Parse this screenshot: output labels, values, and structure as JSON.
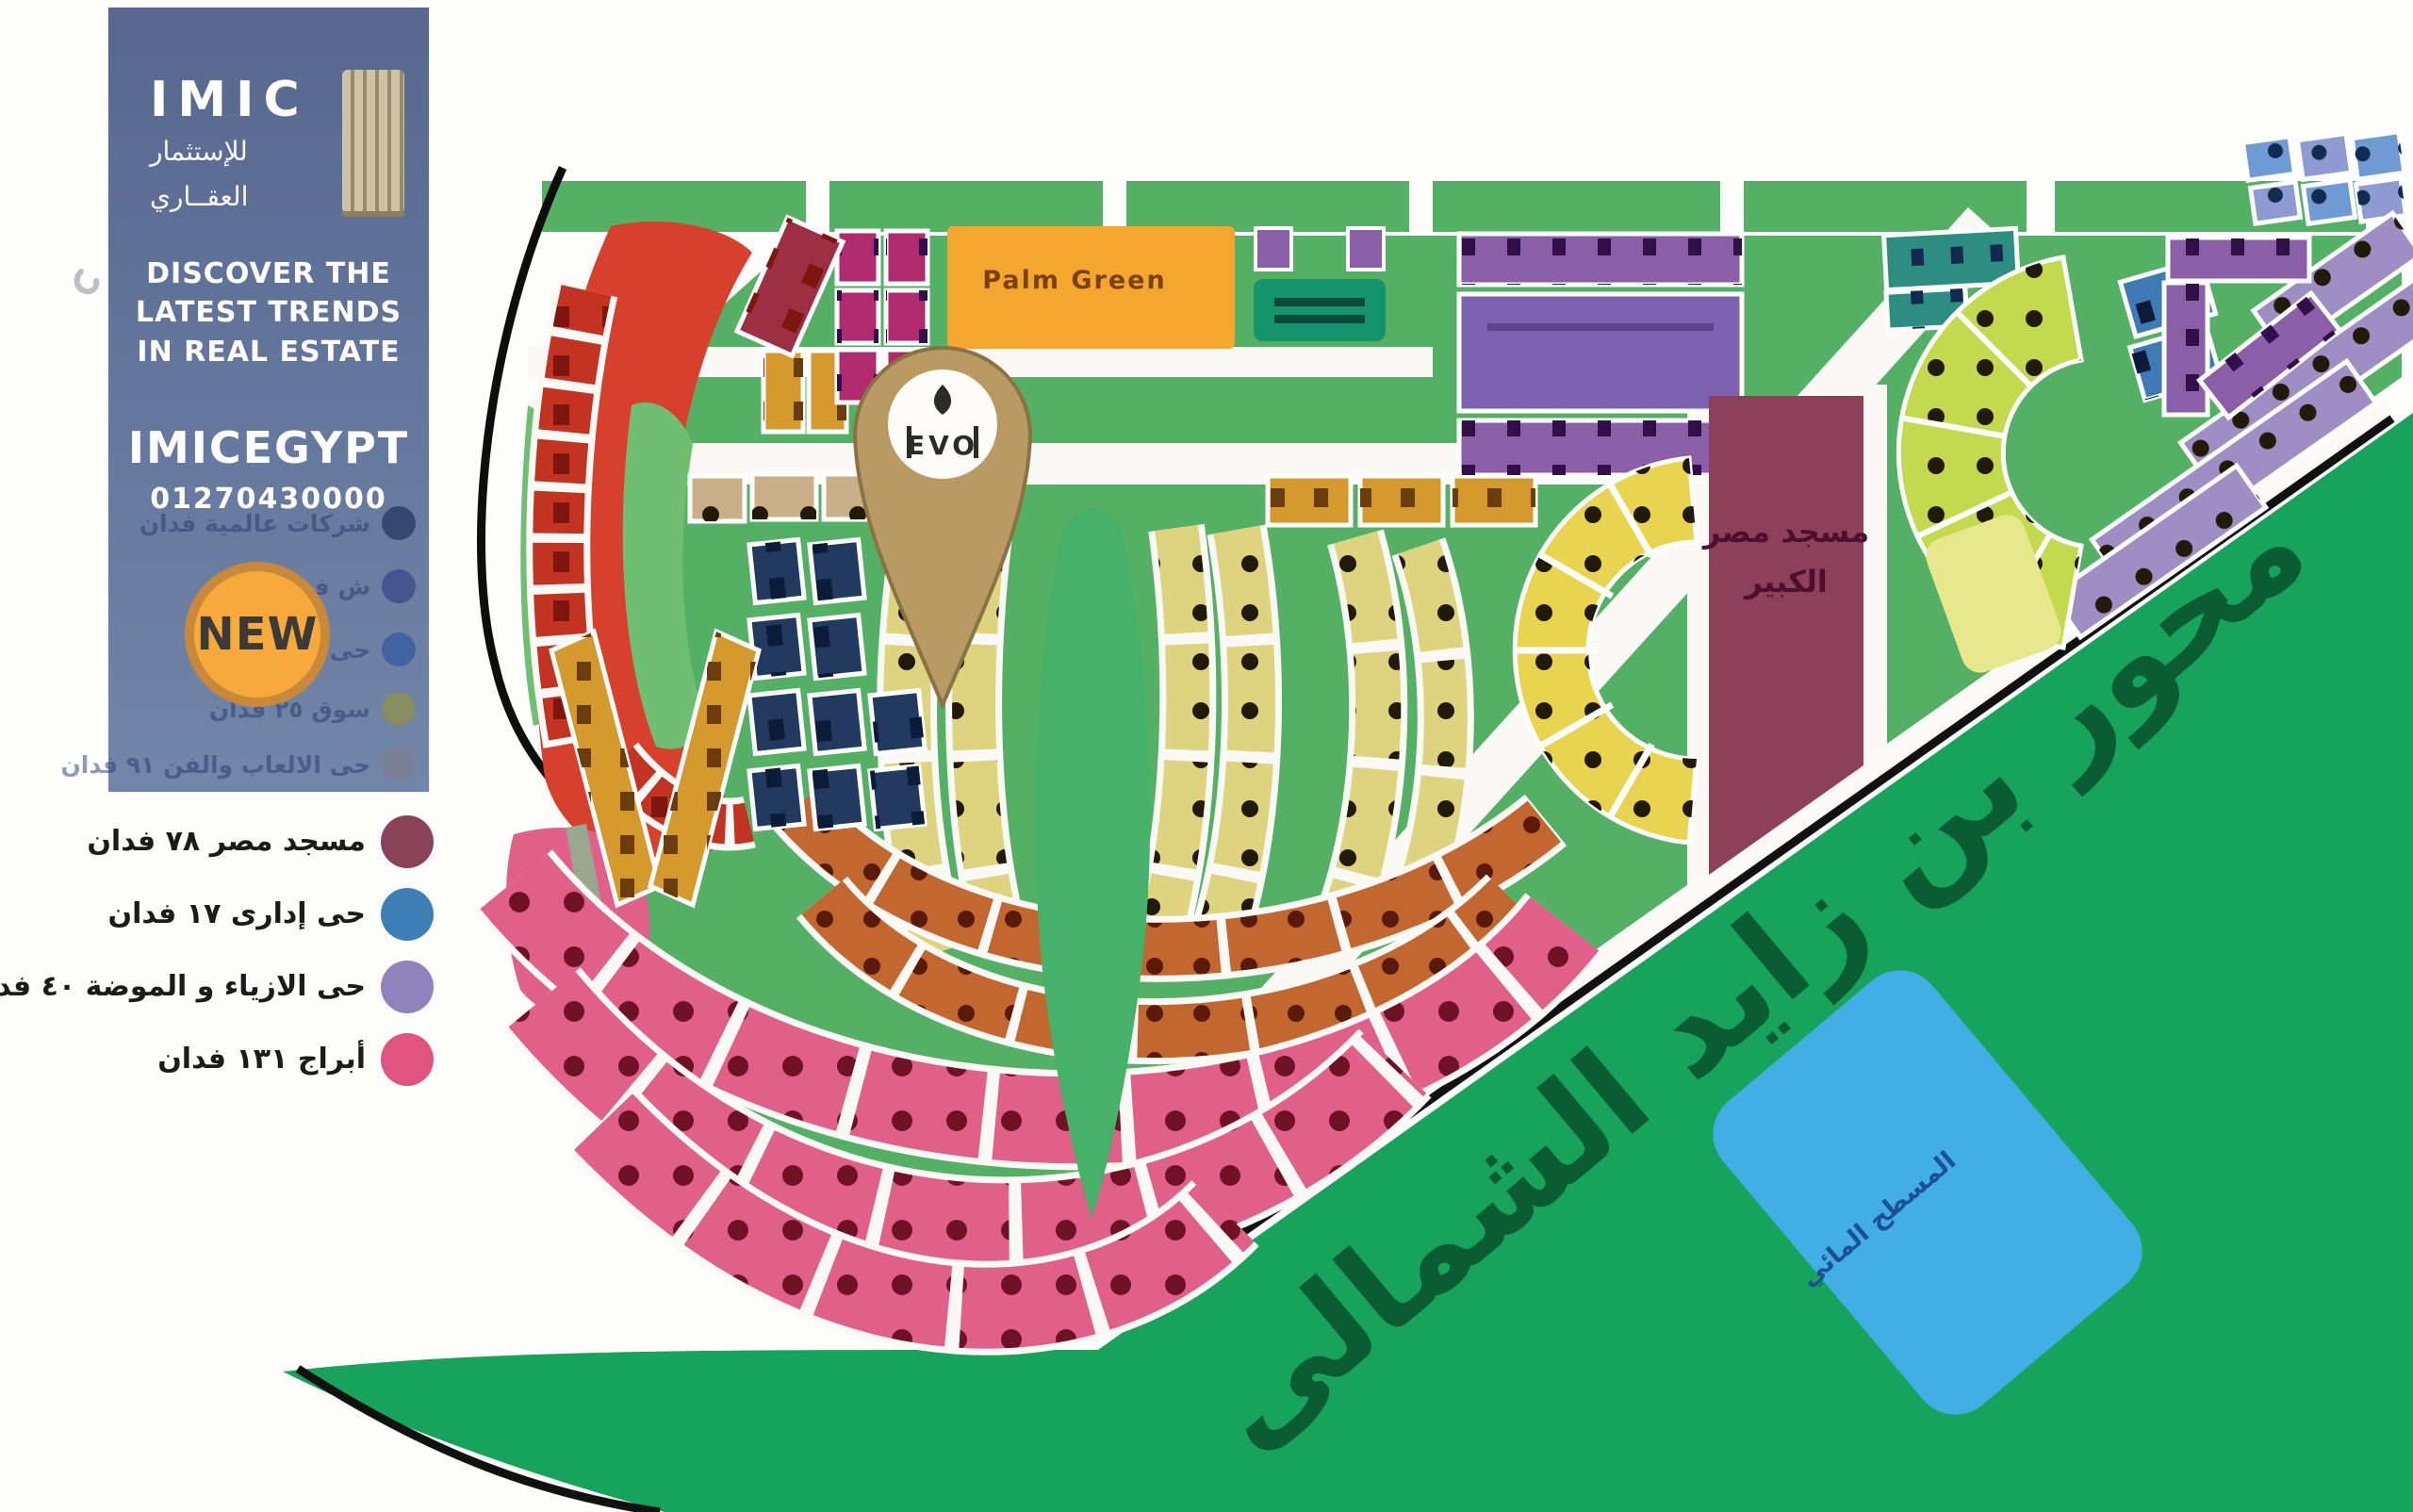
{
  "brand": {
    "logo_title": "IMIC",
    "logo_sub1": "للإستثمار",
    "logo_sub2": "العقــاري",
    "tagline1": "DISCOVER THE",
    "tagline2": "LATEST TRENDS",
    "tagline3": "IN REAL ESTATE",
    "handle": "IMICEGYPT",
    "phone": "01270430000",
    "badge": "NEW",
    "panel_color_top": "#57678e",
    "panel_color_bottom": "#7286a9",
    "badge_color": "#f7a93b",
    "badge_ring_color": "#c8893a",
    "faded_rows": [
      {
        "label": "شركات عالمية فدان",
        "color": "#2e3f66"
      },
      {
        "label": "ش فدان",
        "color": "#3d4f8a"
      },
      {
        "label": "حى فدان",
        "color": "#3a5fa0"
      },
      {
        "label": "سوق ٢٥ فدان",
        "color": "#8a8f55"
      },
      {
        "label": "حى الالعاب والفن ٩١ فدان",
        "color": "#7a7f93"
      }
    ]
  },
  "legend": {
    "items": [
      {
        "label": "مسجد مصر ٧٨ فدان",
        "color": "#8a4257"
      },
      {
        "label": "حى إدارى ١٧ فدان",
        "color": "#3f7fb5"
      },
      {
        "label": "حى الازياء و الموضة ٤٠ فدان",
        "color": "#8f83bd"
      },
      {
        "label": "أبراج ١٣١ فدان",
        "color": "#e0557f"
      }
    ]
  },
  "map": {
    "axis_road_label": "محور بن زايد الشمالى",
    "palm_green_label": "Palm Green",
    "mosque_label_1": "مسجد مصر",
    "mosque_label_2": "الكبير",
    "water_label": "المسطح المائي",
    "pin_logo_text": "EVO",
    "colors": {
      "masterplan_green": "#54b065",
      "band_green": "#17a35b",
      "band_text": "#0a5c33",
      "red": "#d6402c",
      "red_row": "#c23322",
      "crimson": "#9c2f44",
      "magenta": "#b02a6e",
      "orange": "#f4a62f",
      "orange_text": "#7a4214",
      "teal_dark": "#15946b",
      "purple": "#7c62b0",
      "purple_light": "#8a5fa8",
      "navy": "#223a60",
      "gold": "#d49a2e",
      "khaki": "#ded47f",
      "park": "#46b168",
      "terracotta": "#c2672f",
      "pink": "#e0608a",
      "mosque": "#8d4059",
      "mosque_text": "#4f0f2c",
      "yellow": "#e9d44f",
      "chartreuse": "#c3d94e",
      "chartreuse_pale": "#e6e88b",
      "lavender": "#9d8ec4",
      "teal_strip": "#2c8d80",
      "blue_block": "#3f79b6",
      "periwinkle": "#6f9bd4",
      "periwinkle2": "#8e9bd3",
      "beige": "#c9b089",
      "inner_green": "#6fbf73",
      "water": "#41aee4",
      "water_text": "#1d4f94",
      "pin": "#b89a62",
      "pin_edge": "#8a7242",
      "road_black": "#111111"
    }
  }
}
